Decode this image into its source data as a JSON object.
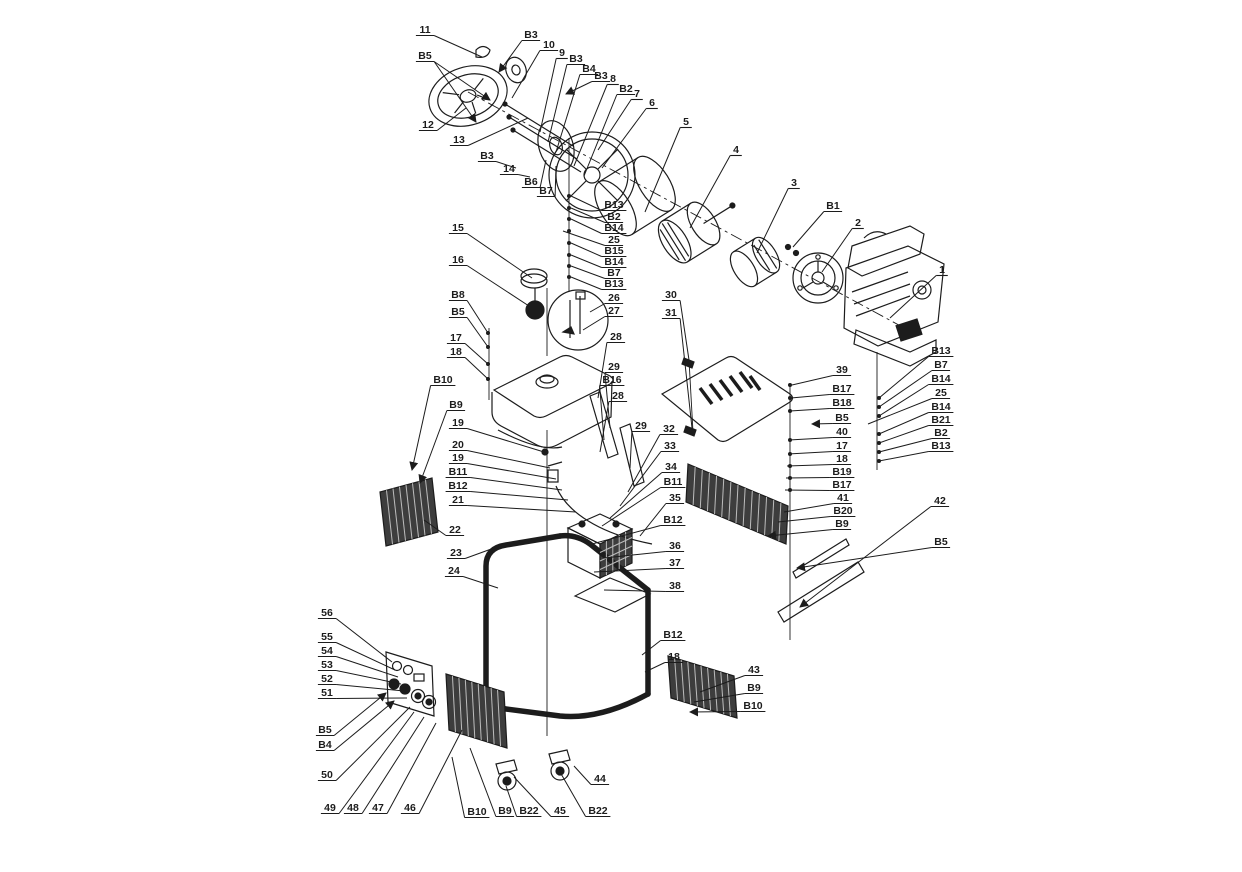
{
  "style": {
    "ink": "#1c1c1c",
    "bg": "#ffffff",
    "panel_fill": "#3d3d3d",
    "slat": "#bdbdbd"
  },
  "canvas": {
    "w": 1242,
    "h": 872
  },
  "callouts": [
    {
      "t": "11",
      "x": 425,
      "y": 31,
      "tx": 482,
      "ty": 57
    },
    {
      "t": "B5",
      "x": 425,
      "y": 57,
      "tx": 490,
      "ty": 100,
      "t2x": 476,
      "t2y": 122,
      "arrow": true
    },
    {
      "t": "12",
      "x": 428,
      "y": 126,
      "tx": 466,
      "ty": 108
    },
    {
      "t": "13",
      "x": 459,
      "y": 141,
      "tx": 528,
      "ty": 118
    },
    {
      "t": "B3",
      "x": 531,
      "y": 36,
      "tx": 499,
      "ty": 72,
      "arrow": true
    },
    {
      "t": "10",
      "x": 549,
      "y": 46,
      "tx": 512,
      "ty": 98
    },
    {
      "t": "9",
      "x": 562,
      "y": 54,
      "tx": 540,
      "ty": 132
    },
    {
      "t": "B3",
      "x": 576,
      "y": 60,
      "tx": 548,
      "ty": 142
    },
    {
      "t": "B4",
      "x": 589,
      "y": 70,
      "tx": 556,
      "ty": 152
    },
    {
      "t": "B3",
      "x": 601,
      "y": 77,
      "tx": 566,
      "ty": 94,
      "arrow": true
    },
    {
      "t": "8",
      "x": 613,
      "y": 80,
      "tx": 574,
      "ty": 166
    },
    {
      "t": "B2",
      "x": 626,
      "y": 90,
      "tx": 584,
      "ty": 176
    },
    {
      "t": "7",
      "x": 637,
      "y": 95,
      "tx": 598,
      "ty": 150
    },
    {
      "t": "6",
      "x": 652,
      "y": 104,
      "tx": 602,
      "ty": 168
    },
    {
      "t": "5",
      "x": 686,
      "y": 123,
      "tx": 645,
      "ty": 212
    },
    {
      "t": "4",
      "x": 736,
      "y": 151,
      "tx": 690,
      "ty": 228
    },
    {
      "t": "3",
      "x": 794,
      "y": 184,
      "tx": 757,
      "ty": 253
    },
    {
      "t": "B1",
      "x": 833,
      "y": 207,
      "tx": 793,
      "ty": 247
    },
    {
      "t": "2",
      "x": 858,
      "y": 224,
      "tx": 822,
      "ty": 272
    },
    {
      "t": "1",
      "x": 942,
      "y": 271,
      "tx": 890,
      "ty": 318
    },
    {
      "t": "30",
      "x": 671,
      "y": 296,
      "tx": 689,
      "ty": 360
    },
    {
      "t": "31",
      "x": 671,
      "y": 314,
      "tx": 692,
      "ty": 428
    },
    {
      "t": "B3",
      "x": 487,
      "y": 157,
      "tx": 516,
      "ty": 168
    },
    {
      "t": "14",
      "x": 509,
      "y": 170,
      "tx": 530,
      "ty": 177
    },
    {
      "t": "B6",
      "x": 531,
      "y": 183,
      "tx": 546,
      "ty": 160
    },
    {
      "t": "B7",
      "x": 546,
      "y": 192,
      "tx": 556,
      "ty": 166
    },
    {
      "t": "B13",
      "x": 614,
      "y": 206,
      "tx": 571,
      "ty": 196
    },
    {
      "t": "B2",
      "x": 614,
      "y": 218,
      "tx": 571,
      "ty": 208
    },
    {
      "t": "B14",
      "x": 614,
      "y": 229,
      "tx": 571,
      "ty": 219
    },
    {
      "t": "25",
      "x": 614,
      "y": 241,
      "tx": 563,
      "ty": 231
    },
    {
      "t": "B15",
      "x": 614,
      "y": 252,
      "tx": 571,
      "ty": 243
    },
    {
      "t": "B14",
      "x": 614,
      "y": 263,
      "tx": 571,
      "ty": 255
    },
    {
      "t": "B7",
      "x": 614,
      "y": 274,
      "tx": 571,
      "ty": 266
    },
    {
      "t": "B13",
      "x": 614,
      "y": 285,
      "tx": 571,
      "ty": 277
    },
    {
      "t": "26",
      "x": 614,
      "y": 299,
      "tx": 590,
      "ty": 312
    },
    {
      "t": "27",
      "x": 614,
      "y": 312,
      "tx": 583,
      "ty": 330
    },
    {
      "t": "28",
      "x": 616,
      "y": 338,
      "tx": 598,
      "ty": 398
    },
    {
      "t": "29",
      "x": 614,
      "y": 368,
      "tx": 610,
      "ty": 428
    },
    {
      "t": "B16",
      "x": 612,
      "y": 381,
      "tx": 604,
      "ty": 440
    },
    {
      "t": "28",
      "x": 618,
      "y": 397,
      "tx": 600,
      "ty": 452
    },
    {
      "t": "29",
      "x": 641,
      "y": 427,
      "tx": 630,
      "ty": 468
    },
    {
      "t": "15",
      "x": 458,
      "y": 229,
      "tx": 532,
      "ty": 278
    },
    {
      "t": "16",
      "x": 458,
      "y": 261,
      "tx": 532,
      "ty": 308
    },
    {
      "t": "B8",
      "x": 458,
      "y": 296,
      "tx": 488,
      "ty": 333
    },
    {
      "t": "B5",
      "x": 458,
      "y": 313,
      "tx": 488,
      "ty": 347
    },
    {
      "t": "17",
      "x": 456,
      "y": 339,
      "tx": 488,
      "ty": 364
    },
    {
      "t": "18",
      "x": 456,
      "y": 353,
      "tx": 488,
      "ty": 379
    },
    {
      "t": "B10",
      "x": 443,
      "y": 381,
      "tx": 412,
      "ty": 470,
      "arrow": true
    },
    {
      "t": "B9",
      "x": 456,
      "y": 406,
      "tx": 420,
      "ty": 483,
      "arrow": true
    },
    {
      "t": "19",
      "x": 458,
      "y": 424,
      "tx": 544,
      "ty": 452
    },
    {
      "t": "20",
      "x": 458,
      "y": 446,
      "tx": 550,
      "ty": 468
    },
    {
      "t": "19",
      "x": 458,
      "y": 459,
      "tx": 556,
      "ty": 479
    },
    {
      "t": "B11",
      "x": 458,
      "y": 473,
      "tx": 562,
      "ty": 490
    },
    {
      "t": "B12",
      "x": 458,
      "y": 487,
      "tx": 568,
      "ty": 500
    },
    {
      "t": "21",
      "x": 458,
      "y": 501,
      "tx": 576,
      "ty": 512
    },
    {
      "t": "22",
      "x": 455,
      "y": 531,
      "tx": 424,
      "ty": 520
    },
    {
      "t": "23",
      "x": 456,
      "y": 554,
      "tx": 494,
      "ty": 548
    },
    {
      "t": "24",
      "x": 454,
      "y": 572,
      "tx": 498,
      "ty": 588
    },
    {
      "t": "32",
      "x": 669,
      "y": 430,
      "tx": 628,
      "ty": 492
    },
    {
      "t": "33",
      "x": 670,
      "y": 447,
      "tx": 620,
      "ty": 506
    },
    {
      "t": "34",
      "x": 671,
      "y": 468,
      "tx": 610,
      "ty": 518
    },
    {
      "t": "B11",
      "x": 673,
      "y": 483,
      "tx": 602,
      "ty": 526
    },
    {
      "t": "35",
      "x": 675,
      "y": 499,
      "tx": 640,
      "ty": 536
    },
    {
      "t": "B12",
      "x": 673,
      "y": 521,
      "tx": 592,
      "ty": 544
    },
    {
      "t": "36",
      "x": 675,
      "y": 547,
      "tx": 604,
      "ty": 558
    },
    {
      "t": "37",
      "x": 675,
      "y": 564,
      "tx": 594,
      "ty": 572
    },
    {
      "t": "38",
      "x": 675,
      "y": 587,
      "tx": 604,
      "ty": 590
    },
    {
      "t": "39",
      "x": 842,
      "y": 371,
      "tx": 792,
      "ty": 385
    },
    {
      "t": "B17",
      "x": 842,
      "y": 390,
      "tx": 791,
      "ty": 398
    },
    {
      "t": "B18",
      "x": 842,
      "y": 404,
      "tx": 790,
      "ty": 411
    },
    {
      "t": "B5",
      "x": 842,
      "y": 419,
      "tx": 812,
      "ty": 424,
      "arrow": true
    },
    {
      "t": "40",
      "x": 842,
      "y": 433,
      "tx": 789,
      "ty": 440
    },
    {
      "t": "17",
      "x": 842,
      "y": 447,
      "tx": 788,
      "ty": 454
    },
    {
      "t": "18",
      "x": 842,
      "y": 460,
      "tx": 787,
      "ty": 466
    },
    {
      "t": "B19",
      "x": 842,
      "y": 473,
      "tx": 786,
      "ty": 478
    },
    {
      "t": "B17",
      "x": 842,
      "y": 486,
      "tx": 785,
      "ty": 490
    },
    {
      "t": "41",
      "x": 843,
      "y": 499,
      "tx": 784,
      "ty": 512
    },
    {
      "t": "B20",
      "x": 843,
      "y": 512,
      "tx": 778,
      "ty": 522
    },
    {
      "t": "B9",
      "x": 842,
      "y": 525,
      "tx": 768,
      "ty": 536,
      "arrow": true
    },
    {
      "t": "B13",
      "x": 941,
      "y": 352,
      "tx": 879,
      "ty": 398
    },
    {
      "t": "B7",
      "x": 941,
      "y": 366,
      "tx": 879,
      "ty": 407
    },
    {
      "t": "B14",
      "x": 941,
      "y": 380,
      "tx": 879,
      "ty": 416
    },
    {
      "t": "25",
      "x": 941,
      "y": 394,
      "tx": 868,
      "ty": 424
    },
    {
      "t": "B14",
      "x": 941,
      "y": 408,
      "tx": 879,
      "ty": 434
    },
    {
      "t": "B21",
      "x": 941,
      "y": 421,
      "tx": 879,
      "ty": 443
    },
    {
      "t": "B2",
      "x": 941,
      "y": 434,
      "tx": 879,
      "ty": 452
    },
    {
      "t": "B13",
      "x": 941,
      "y": 447,
      "tx": 879,
      "ty": 461
    },
    {
      "t": "42",
      "x": 940,
      "y": 502,
      "tx": 800,
      "ty": 607,
      "arrow": true
    },
    {
      "t": "B5",
      "x": 941,
      "y": 543,
      "tx": 797,
      "ty": 568,
      "arrow": true
    },
    {
      "t": "B12",
      "x": 673,
      "y": 636,
      "tx": 642,
      "ty": 655
    },
    {
      "t": "18",
      "x": 674,
      "y": 658,
      "tx": 645,
      "ty": 672
    },
    {
      "t": "43",
      "x": 754,
      "y": 671,
      "tx": 700,
      "ty": 692
    },
    {
      "t": "B9",
      "x": 754,
      "y": 689,
      "tx": 694,
      "ty": 702
    },
    {
      "t": "B10",
      "x": 753,
      "y": 707,
      "tx": 690,
      "ty": 712,
      "arrow": true
    },
    {
      "t": "56",
      "x": 327,
      "y": 614,
      "tx": 392,
      "ty": 662
    },
    {
      "t": "55",
      "x": 327,
      "y": 638,
      "tx": 395,
      "ty": 670
    },
    {
      "t": "54",
      "x": 327,
      "y": 652,
      "tx": 398,
      "ty": 677
    },
    {
      "t": "53",
      "x": 327,
      "y": 666,
      "tx": 401,
      "ty": 684
    },
    {
      "t": "52",
      "x": 327,
      "y": 680,
      "tx": 404,
      "ty": 691
    },
    {
      "t": "51",
      "x": 327,
      "y": 694,
      "tx": 407,
      "ty": 698
    },
    {
      "t": "B5",
      "x": 325,
      "y": 731,
      "tx": 386,
      "ty": 693,
      "arrow": true
    },
    {
      "t": "B4",
      "x": 325,
      "y": 746,
      "tx": 394,
      "ty": 701,
      "arrow": true
    },
    {
      "t": "50",
      "x": 327,
      "y": 776,
      "tx": 410,
      "ty": 707
    },
    {
      "t": "49",
      "x": 330,
      "y": 809,
      "tx": 414,
      "ty": 712
    },
    {
      "t": "48",
      "x": 353,
      "y": 809,
      "tx": 424,
      "ty": 717
    },
    {
      "t": "47",
      "x": 378,
      "y": 809,
      "tx": 436,
      "ty": 723
    },
    {
      "t": "46",
      "x": 410,
      "y": 809,
      "tx": 462,
      "ty": 730
    },
    {
      "t": "B10",
      "x": 477,
      "y": 813,
      "tx": 452,
      "ty": 757
    },
    {
      "t": "B9",
      "x": 505,
      "y": 812,
      "tx": 470,
      "ty": 748
    },
    {
      "t": "B22",
      "x": 529,
      "y": 812,
      "tx": 506,
      "ty": 786
    },
    {
      "t": "45",
      "x": 560,
      "y": 812,
      "tx": 514,
      "ty": 777
    },
    {
      "t": "B22",
      "x": 598,
      "y": 812,
      "tx": 560,
      "ty": 772
    },
    {
      "t": "44",
      "x": 600,
      "y": 780,
      "tx": 574,
      "ty": 766
    }
  ]
}
